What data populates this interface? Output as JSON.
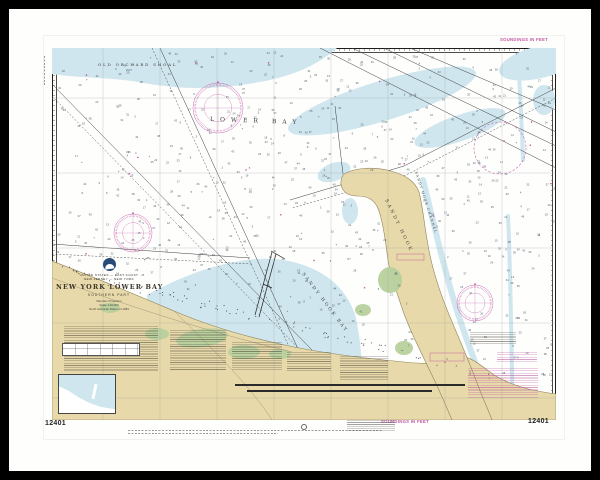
{
  "colors": {
    "frame": "#000000",
    "paper": "#fefefd",
    "shoal": "#cfe6ee",
    "land": "#e8d9aa",
    "land_edge": "#8f825a",
    "green": "#b7d09c",
    "magenta": "#c257a4",
    "ink": "#333333",
    "sounding": "#51626c",
    "graticule": "#9aa0a0"
  },
  "margin": {
    "chart_number_left": "12401",
    "chart_number_right": "12401",
    "soundings_top": "SOUNDINGS IN FEET",
    "soundings_bottom": "SOUNDINGS IN FEET"
  },
  "title_block": {
    "country": "UNITED STATES — EAST COAST",
    "region": "NEW JERSEY — NEW YORK",
    "title": "NEW YORK LOWER BAY",
    "subtitle": "SOUTHERN PART",
    "detail_lines": [
      "Mercator Projection",
      "Scale 1:40,000",
      "North American Datum of 1983"
    ]
  },
  "place_labels": [
    {
      "text": "OLD ORCHARD SHOAL",
      "x": 46,
      "y": 18,
      "rot": 0,
      "fs": 4.0,
      "ls": 1.8,
      "color": "#3c3c3c"
    },
    {
      "text": "LOWER BAY",
      "x": 158,
      "y": 73,
      "rot": 2,
      "fs": 6.0,
      "ls": 6.0,
      "color": "#3c3c3c"
    },
    {
      "text": "SANDY HOOK",
      "x": 333,
      "y": 152,
      "rot": 64,
      "fs": 4.6,
      "ls": 2.5,
      "color": "#45453c"
    },
    {
      "text": "SANDY HOOK CHANNEL",
      "x": 363,
      "y": 124,
      "rot": 72,
      "fs": 3.3,
      "ls": 1.2,
      "color": "#3c3c3c"
    },
    {
      "text": "SANDY HOOK BAY",
      "x": 250,
      "y": 226,
      "rot": 53,
      "fs": 4.4,
      "ls": 2.2,
      "color": "#3c3c3c"
    }
  ],
  "compass_roses": [
    {
      "cx": 81,
      "cy": 185,
      "r": 19
    },
    {
      "cx": 166,
      "cy": 60,
      "r": 25
    },
    {
      "cx": 423,
      "cy": 255,
      "r": 18
    }
  ],
  "caution_circles": [
    {
      "cx": 448,
      "cy": 100,
      "r": 26
    }
  ],
  "soundings": {
    "count": 820,
    "min": 2,
    "max": 47,
    "seed": 20240601
  }
}
